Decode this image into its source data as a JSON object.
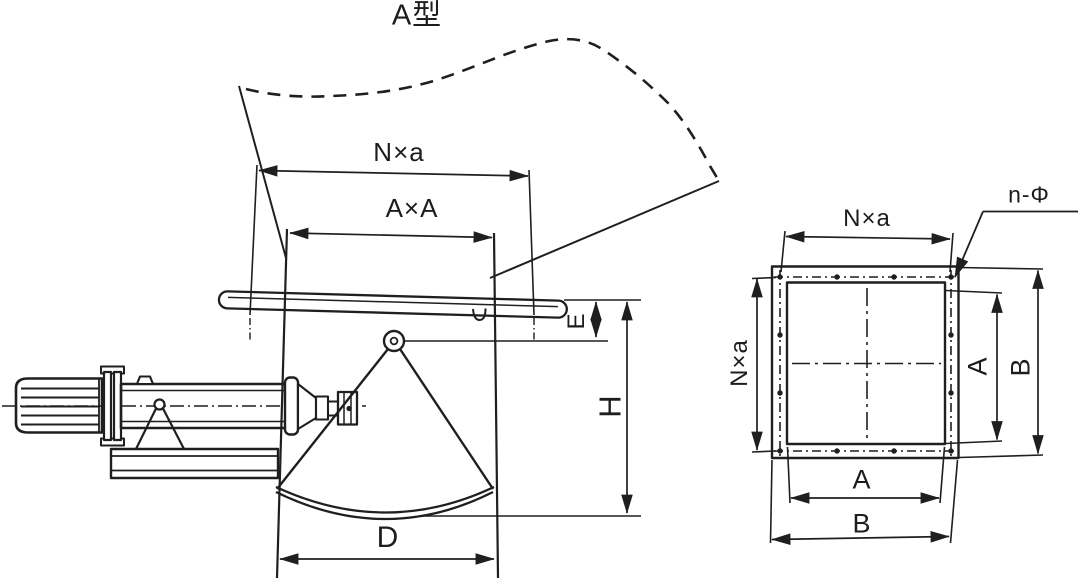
{
  "title": "A型",
  "palette": {
    "ink": "#1f1f1f",
    "paper": "#ffffff"
  },
  "left_view": {
    "description": "side elevation of sector gate valve with electric actuator",
    "dims": {
      "bolt_pitch_top": "N×a",
      "opening": "A×A",
      "pivot_offset": "E",
      "overall_height": "H",
      "gate_width": "D"
    }
  },
  "right_view": {
    "description": "flange plan view with bolt holes",
    "dims": {
      "bolt_pitch_top": "N×a",
      "bolt_pitch_left": "N×a",
      "opening_width": "A",
      "overall_width": "B",
      "opening_height": "A",
      "overall_height": "B"
    },
    "bolt_callout": "n-Φ"
  }
}
